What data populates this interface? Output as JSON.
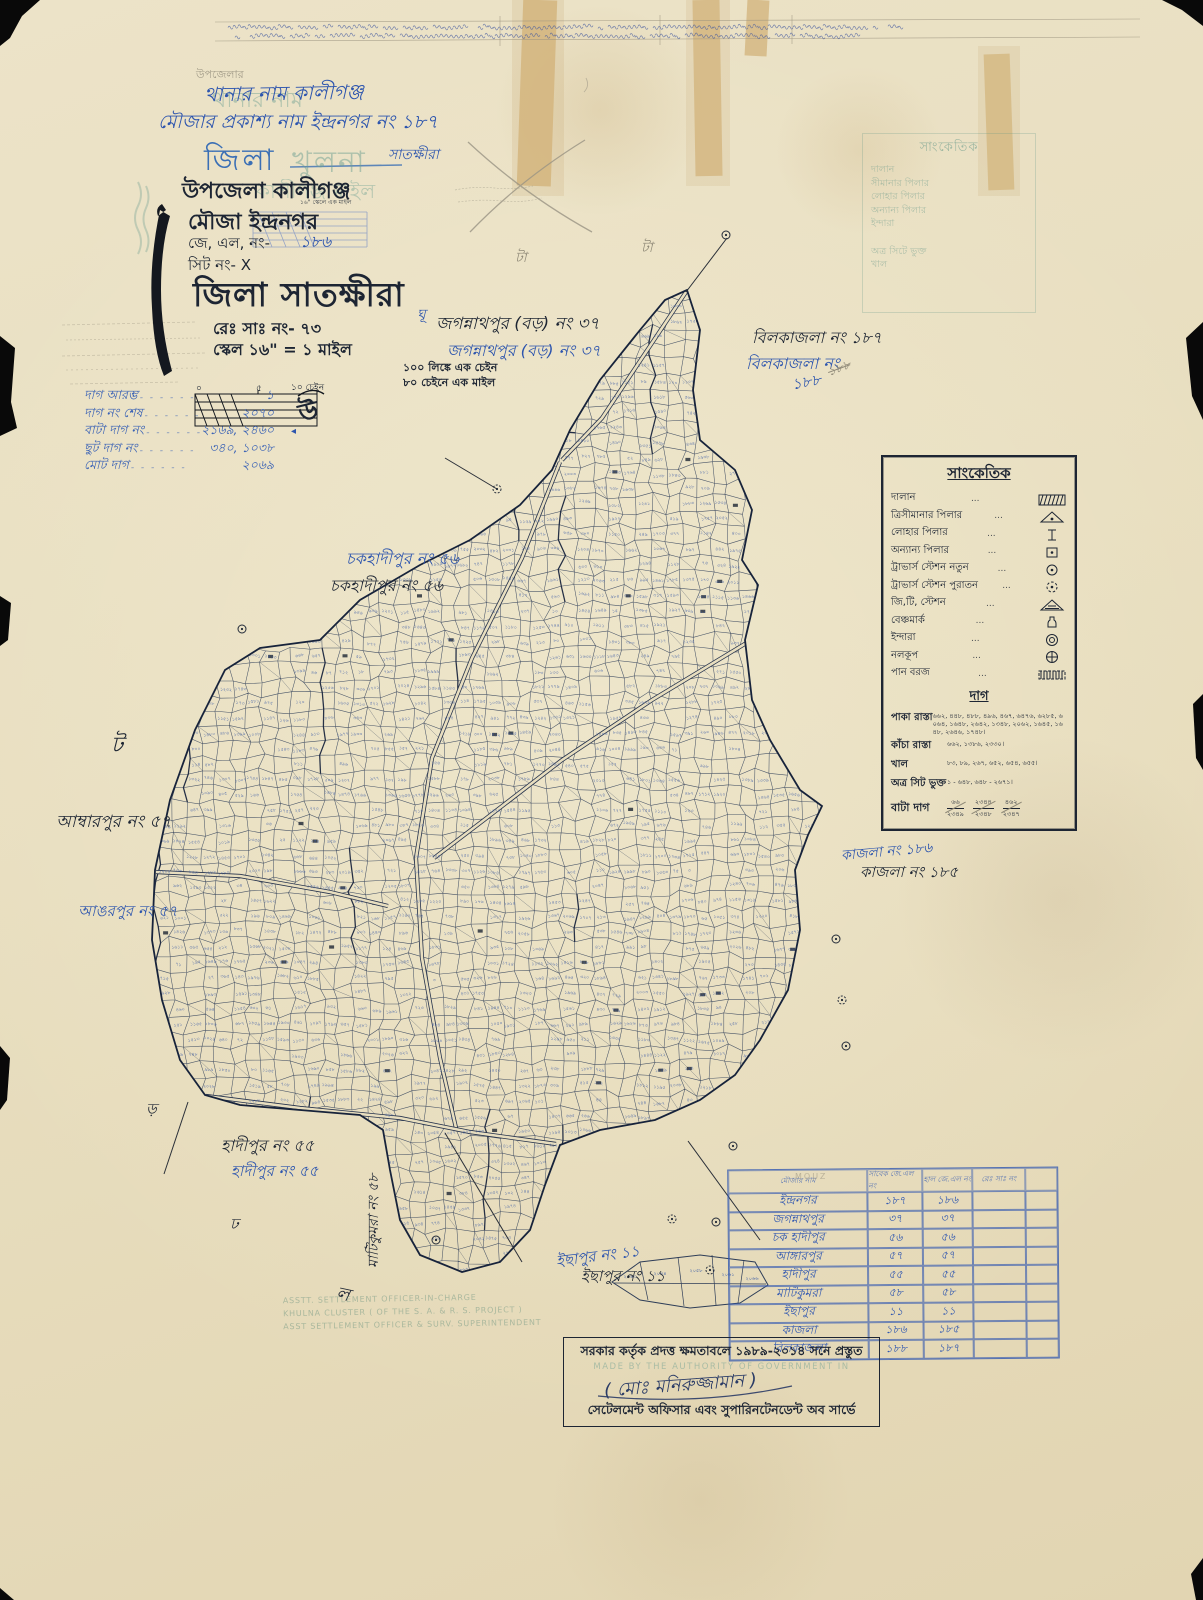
{
  "header": {
    "thana_pencil": "উপজেলার",
    "thana_ghost": "থানার নাম",
    "thana_line": "থানার নাম  কালীগঞ্জ",
    "mouza_pub_line": "মৌজার প্রকাশ্য নাম  ইন্দ্রনগর নং ১৮৭",
    "district_print": "জিলা",
    "district_ghost": "খুলনা",
    "district_hand": "সাতক্ষীরা",
    "upazila_line": "উপজেলা কালীগঞ্জ",
    "upazila_ghost": "কালীগঞ্জ মাইল",
    "mouza_line": "মৌজা ইন্দ্রনগর",
    "tiny_print": "১৬\" স্কেলে এক মাইল",
    "jl_label": "জে, এল, নং-",
    "jl_value": "১৮৬",
    "sheet_line": "সিট নং- X",
    "district_big": "জিলা সাতক্ষীরা",
    "reg_line": "রেঃ সাঃ নং- ৭৩",
    "scale_line": "স্কেল ১৬\" = ১ মাইল"
  },
  "scale": {
    "note1": "১০০ লিঙ্কে এক চেইন",
    "note2": "৮০ চেইনে এক মাইল",
    "tick0": "০",
    "tick5": "৫",
    "tick10": "১০ চেইন",
    "north": "উ",
    "north_tri": "◂"
  },
  "dag_summary": [
    {
      "label": "দাগ আরম্ভ",
      "value": "১"
    },
    {
      "label": "দাগ নং শেষ",
      "value": "২০৭০"
    },
    {
      "label": "বাটা দাগ নং",
      "value": "২১৬৯, ২৪৬০"
    },
    {
      "label": "ছুট দাগ নং",
      "value": "৩৪০, ১০৩৮"
    },
    {
      "label": "মোট দাগ",
      "value": "২০৬৯"
    }
  ],
  "ghost_legend": {
    "title": "সাংকেতিক",
    "items": [
      "দালান",
      "সীমানার পিলার",
      "লোহার পিলার",
      "অন্যান্য পিলার",
      "ইন্দারা",
      "অত্র সিটে ভুক্ত",
      "খাল"
    ]
  },
  "legend": {
    "title": "সাংকেতিক",
    "dots": "...",
    "items": [
      {
        "label": "দালান",
        "symbol": "hatch-rect"
      },
      {
        "label": "ত্রিসীমানার পিলার",
        "symbol": "tri-dot"
      },
      {
        "label": "লোহার পিলার",
        "symbol": "ibeam"
      },
      {
        "label": "অন্যান্য পিলার",
        "symbol": "sq-dot"
      },
      {
        "label": "ট্রাভার্স স্টেশন নতুন",
        "symbol": "circ-dot"
      },
      {
        "label": "ট্রাভার্স স্টেশন পুরাতন",
        "symbol": "circ-dash-dot"
      },
      {
        "label": "জি,টি, স্টেশন",
        "symbol": "tri-hatch"
      },
      {
        "label": "বেঞ্চমার্ক",
        "symbol": "bottle"
      },
      {
        "label": "ইন্দারা",
        "symbol": "double-circ"
      },
      {
        "label": "নলকূপ",
        "symbol": "circ-cross"
      },
      {
        "label": "পান বরজ",
        "symbol": "pan-rect"
      }
    ],
    "dag_title": "দাগ",
    "dag_rows": [
      {
        "label": "পাকা রাস্তা",
        "value": "৬৬২, ৪৪৮, ৪৮৮, ৪৯৬, ৪৬৭, ৬৪৭৬, ৬২৮৫, ৬০৬৪, ১৬৪৮, ২৬৪২, ১৩৪৮, ২০৬২, ১৬৪৫, ১৬৪৮, ২৬৪৬, ১৭৪৮।"
      },
      {
        "label": "কাঁচা রাস্তা",
        "value": "৬৬২, ১৩৮৬, ২৩৩০।"
      },
      {
        "label": "খাল",
        "value": "৮৩, ৮৯, ২৬৭, ৬৫২, ৬৫৪, ৬৫৫।"
      },
      {
        "label": "অত্র সিট ভুক্ত",
        "value": "১ - ৬৪৮, ৬৪৮ - ২৬৭১।"
      }
    ],
    "bata_label": "বাটা দাগ",
    "bata_fracs": [
      {
        "nu": "৬৬",
        "de": "২৩৪৯"
      },
      {
        "nu": "২৩৪৪",
        "de": "২৩৪৮"
      },
      {
        "nu": "৪৬২",
        "de": "২৩৪৭"
      }
    ]
  },
  "annotations": [
    {
      "t": "জগন্নাথপুর (বড়) নং ৩৭",
      "x": 436,
      "y": 311,
      "c": "ink",
      "fs": 17
    },
    {
      "t": "জগন্নাথপুর (বড়) নং ৩৭",
      "x": 447,
      "y": 338,
      "c": "blue",
      "fs": 16
    },
    {
      "t": "বিলকাজলা নং ১৮৭",
      "x": 752,
      "y": 325,
      "c": "ink",
      "fs": 16
    },
    {
      "t": "বিলকাজলা নং",
      "x": 746,
      "y": 351,
      "c": "blue",
      "fs": 16
    },
    {
      "t": "১৮৮",
      "x": 792,
      "y": 371,
      "c": "blue",
      "fs": 15,
      "rot": -10
    },
    {
      "t": "১৮৮",
      "x": 828,
      "y": 360,
      "c": "pencil strike",
      "fs": 12,
      "rot": -20
    },
    {
      "t": "চকহাদীপুর নং ৫৬",
      "x": 346,
      "y": 546,
      "c": "blue",
      "fs": 16
    },
    {
      "t": "চকহাদীপুর নং ৫৬",
      "x": 330,
      "y": 573,
      "c": "ink",
      "fs": 16
    },
    {
      "t": "আম্বারপুর নং ৫৭",
      "x": 56,
      "y": 809,
      "c": "ink",
      "fs": 17
    },
    {
      "t": "আঙরপুর নং ৫৭",
      "x": 78,
      "y": 900,
      "c": "blue",
      "fs": 15
    },
    {
      "t": "কাজলা নং ১৮৬",
      "x": 841,
      "y": 840,
      "c": "blue",
      "fs": 14,
      "rot": -5
    },
    {
      "t": "কাজলা নং ১৮৫",
      "x": 860,
      "y": 861,
      "c": "ink",
      "fs": 15
    },
    {
      "t": "হাদীপুর নং ৫৫",
      "x": 221,
      "y": 1133,
      "c": "ink",
      "fs": 16
    },
    {
      "t": "হাদীপুর নং ৫৫",
      "x": 231,
      "y": 1160,
      "c": "blue",
      "fs": 15
    },
    {
      "t": "মাটিকুমরা নং ৫৮",
      "x": 362,
      "y": 1268,
      "c": "ink",
      "fs": 14,
      "vert": true
    },
    {
      "t": "ইছাপুর নং ১১",
      "x": 556,
      "y": 1245,
      "c": "blue",
      "fs": 15,
      "rot": -7
    },
    {
      "t": "ইছাপুর নং ১১",
      "x": 581,
      "y": 1265,
      "c": "ink",
      "fs": 15
    },
    {
      "t": "টা",
      "x": 515,
      "y": 246,
      "c": "pencil",
      "fs": 14
    },
    {
      "t": "টা",
      "x": 641,
      "y": 236,
      "c": "pencil",
      "fs": 14
    },
    {
      "t": "ঘূ",
      "x": 417,
      "y": 303,
      "c": "blue",
      "fs": 14
    },
    {
      "t": "ট",
      "x": 111,
      "y": 728,
      "c": "ink",
      "fs": 22
    },
    {
      "t": "ড়",
      "x": 146,
      "y": 1098,
      "c": "ink",
      "fs": 15
    },
    {
      "t": "ঢ",
      "x": 230,
      "y": 1213,
      "c": "ink",
      "fs": 15
    },
    {
      "t": "ল",
      "x": 336,
      "y": 1280,
      "c": "ink",
      "fs": 18,
      "rot": 12
    }
  ],
  "table": {
    "headers": [
      "মৌজার নাম",
      "সাবেক জে.এল নং",
      "হাল জে.এল নং",
      "রেঃ সাঃ নং",
      ""
    ],
    "pencil_note": "MOUZ",
    "rows": [
      [
        "ইন্দ্রনগর",
        "১৮৭",
        "১৮৬"
      ],
      [
        "জগন্নাথপুর",
        "৩৭",
        "৩৭"
      ],
      [
        "চক হাদীপুর",
        "৫৬",
        "৫৬"
      ],
      [
        "আঙ্গারপুর",
        "৫৭",
        "৫৭"
      ],
      [
        "হাদীপুর",
        "৫৫",
        "৫৫"
      ],
      [
        "মাটিকুমরা",
        "৫৮",
        "৫৮"
      ],
      [
        "ইছাপুর",
        "১১",
        "১১"
      ],
      [
        "কাজলা",
        "১৮৬",
        "১৮৫"
      ],
      [
        "বিলকাজলা",
        "১৮৮",
        "১৮৭"
      ]
    ]
  },
  "footer": {
    "line1": "সরকার কর্তৃক প্রদত্ত ক্ষমতাবলে ১৯৮৯-২০১৪ সনে প্রস্তুত",
    "ghost": "MADE BY THE AUTHORITY OF GOVERNMENT IN",
    "signature": "( মোঃ মনিরুজ্জামান )",
    "line3": "সেটেলমেন্ট অফিসার এবং সুপারিনটেনডেন্ট অব সার্ভে"
  },
  "stamp_lines": [
    "ASSTT. SETTLEMENT OFFICER-IN-CHARGE",
    "KHULNA CLUSTER ( OF THE S. A. & R. S. PROJECT )",
    "ASST SETTLEMENT OFFICER & SURV. SUPERINTENDENT"
  ],
  "colors": {
    "paper": "#e9dfc2",
    "blue_ink": "#2d55ae",
    "black_ink": "#1d2533",
    "pencil": "#8e8877",
    "teal_ghost": "#6fa092",
    "map_line": "#2e3d58",
    "plot_number": "#3a5aa6"
  }
}
